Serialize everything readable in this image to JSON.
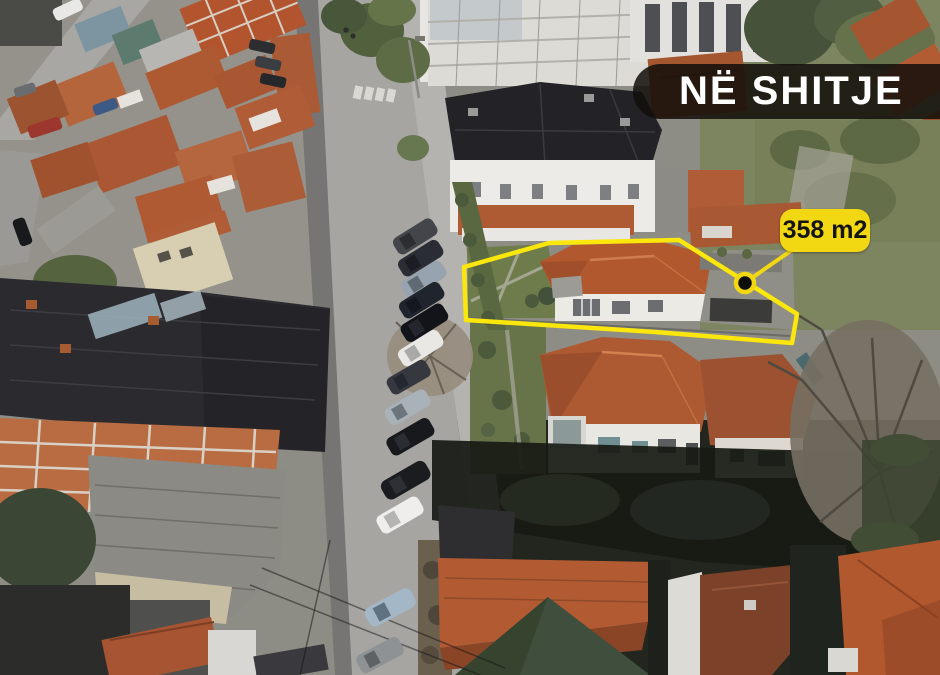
{
  "listing": {
    "status_banner": "NË SHITJE",
    "area_label": "358 m2"
  },
  "colors": {
    "highlight_yellow": "#FBE70C",
    "badge_yellow": "#F2D713",
    "banner_black": "#130E0A",
    "roof_orange": "#B2582F",
    "roof_dark": "#2B2B2F",
    "street_gray": "#A6A5A1",
    "lawn_green": "#6E7C4B"
  }
}
